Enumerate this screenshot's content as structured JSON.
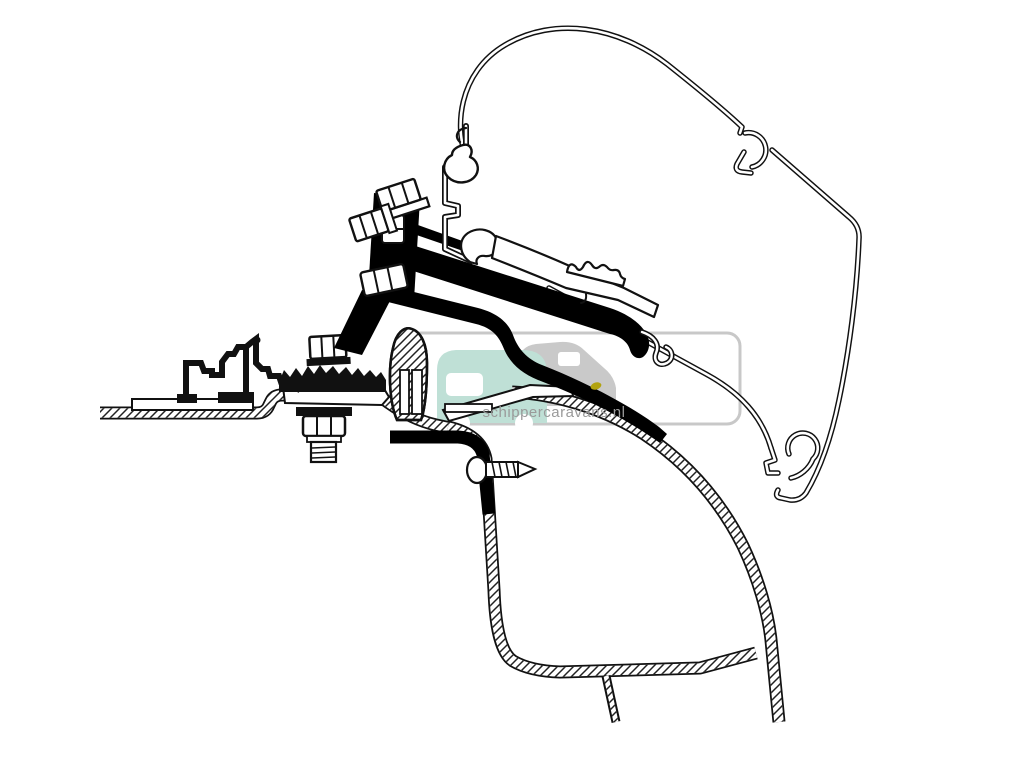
{
  "canvas": {
    "width": 1024,
    "height": 757,
    "background": "#ffffff"
  },
  "diagram": {
    "type": "technical-cross-section",
    "subject": "Awning mounting adapter bracket fitted between van roof rail and door frame (side cross-section)",
    "line_color": "#111111",
    "solid_color": "#000000"
  },
  "watermark": {
    "text": "schippercaravans.nl",
    "text_color": "#9a9a9a",
    "border_color": "#c8c8c8",
    "caravan_color": "#bfe0d6",
    "van_color": "#c9c9c9",
    "wheel_color": "#8f8f8f",
    "accent_dot_color": "#b2a30f"
  },
  "parts": {
    "awning_case": "awning cassette profile",
    "adapter_rail": "adapter top rail profile",
    "bracket": "mounting bracket plate",
    "bolt_upper": "hex bolt (upper clamp)",
    "bolt_left": "hex bolt (side clamp)",
    "clamp_nut": "clamp nut",
    "roof_rail": "vehicle roof rail profile",
    "roof_sheet": "vehicle roof sheet metal",
    "seal": "rubber door seal section",
    "foot_bolt": "foot fixing bolt",
    "lock_nut": "lock nut with threaded stud",
    "door_frame": "vehicle door frame section",
    "screw": "self-tapping screw",
    "l_bracket": "L-shaped lower bracket",
    "support_arm": "curved support arm"
  }
}
